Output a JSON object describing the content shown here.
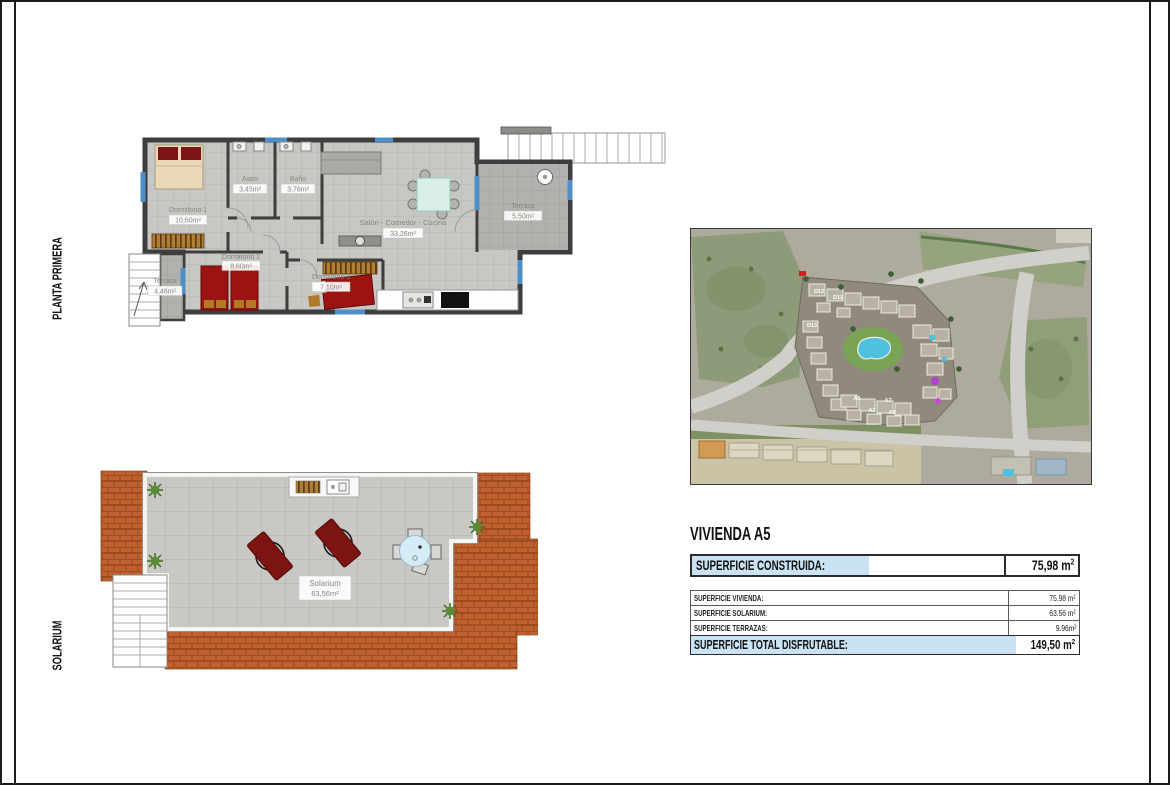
{
  "side_labels": {
    "planta_primera": "PLANTA PRIMERA",
    "solarium": "SOLARIUM"
  },
  "floorplan": {
    "rooms": [
      {
        "name": "Dormitorio 1",
        "area": "10,50m²"
      },
      {
        "name": "Aseo",
        "area": "3,45m²"
      },
      {
        "name": "Baño",
        "area": "3,76m²"
      },
      {
        "name": "Salón - Comedor - Cocina",
        "area": "33,26m²"
      },
      {
        "name": "Terraza",
        "area": "5,50m²"
      },
      {
        "name": "Dormitorio 2",
        "area": "8,60m²"
      },
      {
        "name": "Dormitorio 3",
        "area": "7,10m²"
      },
      {
        "name": "Terraza",
        "area": "4,46m²"
      }
    ]
  },
  "solarium_plan": {
    "label": "Solarium",
    "area": "63,56m²"
  },
  "site_map": {
    "building_labels": [
      "D12",
      "D11",
      "D13",
      "A5",
      "A2",
      "A7",
      "A1"
    ]
  },
  "info": {
    "title": "VIVIENDA A5",
    "highlight_color": "#c9e3f4",
    "construida": {
      "label": "SUPERFICIE CONSTRUIDA:",
      "value": "75,98",
      "unit": " m",
      "sup": "2"
    },
    "rows": [
      {
        "label": "SUPERFICIE VIVIENDA:",
        "value": "75.98 m²"
      },
      {
        "label": "SUPERFICIE SOLARIUM:",
        "value": "63.56 m²"
      },
      {
        "label": "SUPERFICIE TERRAZAS:",
        "value": "9.96m²"
      }
    ],
    "total": {
      "label": "SUPERFICIE TOTAL DISFRUTABLE:",
      "value": "149,50",
      "unit": " m",
      "sup": "2"
    }
  }
}
